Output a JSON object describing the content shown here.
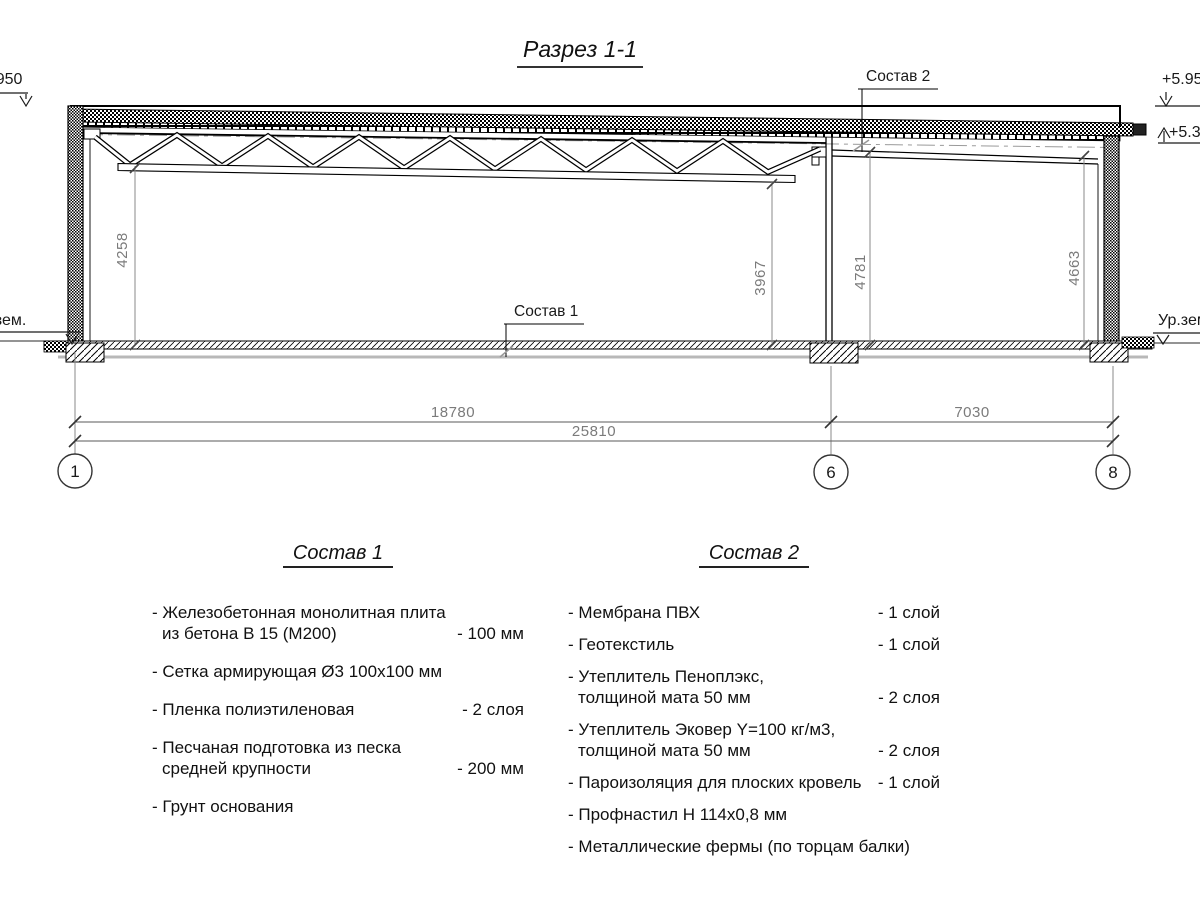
{
  "title": "Разрез 1-1",
  "drawing": {
    "elev_left": "+5.950",
    "elev_right_top": "+5.950",
    "elev_right_low": "+5.380",
    "ground_left": "Ур.зем.",
    "ground_right": "Ур.зем.",
    "callout_1": "Состав 1",
    "callout_2": "Состав 2",
    "dims": {
      "left_height": "4258",
      "truss_right_height": "3967",
      "mid_height": "4781",
      "right_height": "4663",
      "span_main": "18780",
      "span_right": "7030",
      "span_total": "25810"
    },
    "axes": {
      "a1": "1",
      "a6": "6",
      "a8": "8"
    }
  },
  "composition1": {
    "title": "Состав 1",
    "items": [
      {
        "line1": "- Железобетонная  монолитная плита",
        "line2": "из бетона В 15 (М200)",
        "value": "- 100 мм"
      },
      {
        "line1": "- Сетка армирующая Ø3 100х100 мм",
        "line2": "",
        "value": ""
      },
      {
        "line1": "- Пленка полиэтиленовая",
        "line2": "",
        "value": "-  2 слоя"
      },
      {
        "line1": "- Песчаная подготовка из песка",
        "line2": "средней крупности",
        "value": "- 200 мм"
      },
      {
        "line1": "- Грунт основания",
        "line2": "",
        "value": ""
      }
    ]
  },
  "composition2": {
    "title": "Состав 2",
    "items": [
      {
        "line1": "- Мембрана ПВХ",
        "line2": "",
        "value": "- 1 слой"
      },
      {
        "line1": "- Геотекстиль",
        "line2": "",
        "value": "- 1 слой"
      },
      {
        "line1": "- Утеплитель Пеноплэкс,",
        "line2": "толщиной мата 50 мм",
        "value": "- 2 слоя"
      },
      {
        "line1": "- Утеплитель Эковер Y=100 кг/м3,",
        "line2": "толщиной мата 50 мм",
        "value": "- 2 слоя"
      },
      {
        "line1": "- Пароизоляция для плоских кровель",
        "line2": "",
        "value": "- 1 слой"
      },
      {
        "line1": "- Профнастил Н 114х0,8 мм",
        "line2": "",
        "value": ""
      },
      {
        "line1": "- Металлические фермы (по торцам балки)",
        "line2": "",
        "value": ""
      }
    ]
  }
}
